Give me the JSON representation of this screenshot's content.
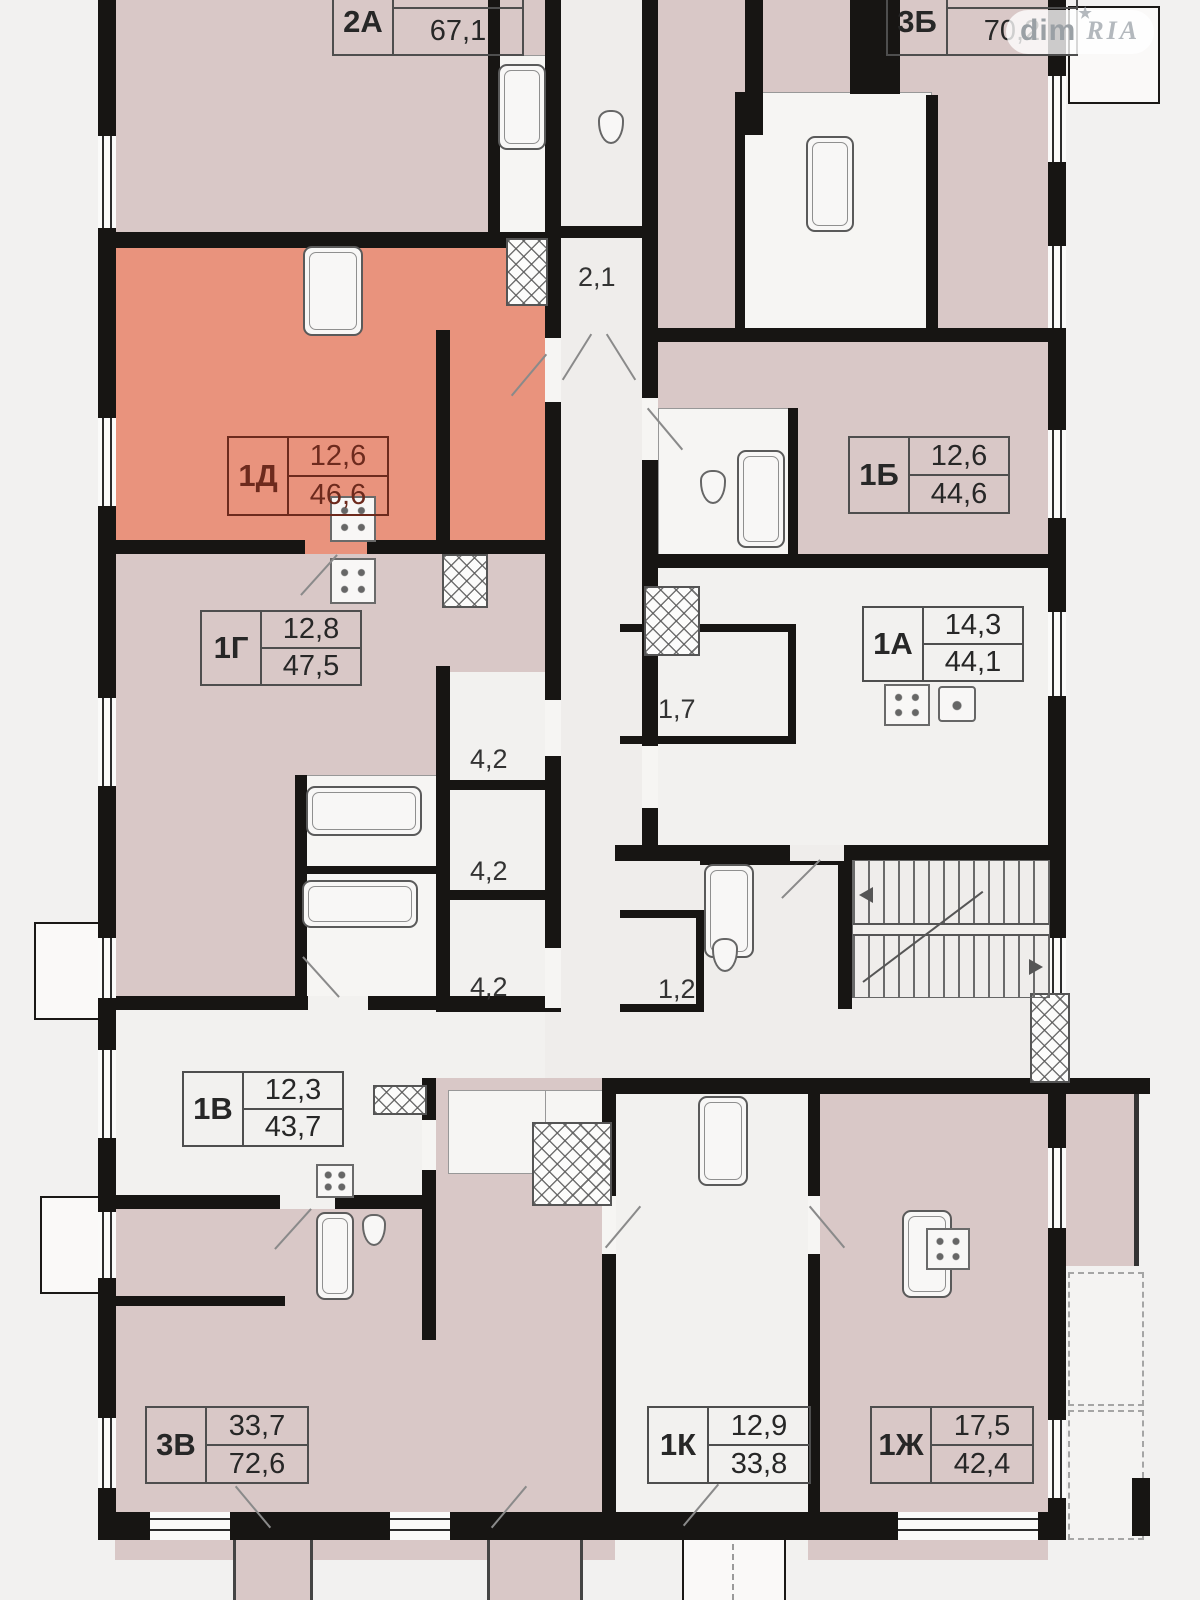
{
  "watermark": {
    "prefix": "dim",
    "brand": "RIA",
    "star": "★"
  },
  "colors": {
    "highlight_fill": "#e9937d",
    "highlight_line": "#6d2a1d",
    "apartment_pink": "#d9c8c7",
    "apartment_white": "#f2f1ef",
    "wall": "#171513",
    "background": "#f2f1f0"
  },
  "apartments": [
    {
      "unit": "2А",
      "living_area": "25,5",
      "total_area": "67,1",
      "highlighted": false
    },
    {
      "unit": "3Б",
      "living_area": "33,7",
      "total_area": "70,2",
      "highlighted": false
    },
    {
      "unit": "1Д",
      "living_area": "12,6",
      "total_area": "46,6",
      "highlighted": true
    },
    {
      "unit": "1Б",
      "living_area": "12,6",
      "total_area": "44,6",
      "highlighted": false
    },
    {
      "unit": "1Г",
      "living_area": "12,8",
      "total_area": "47,5",
      "highlighted": false
    },
    {
      "unit": "1А",
      "living_area": "14,3",
      "total_area": "44,1",
      "highlighted": false
    },
    {
      "unit": "1В",
      "living_area": "12,3",
      "total_area": "43,7",
      "highlighted": false
    },
    {
      "unit": "3В",
      "living_area": "33,7",
      "total_area": "72,6",
      "highlighted": false
    },
    {
      "unit": "1К",
      "living_area": "12,9",
      "total_area": "33,8",
      "highlighted": false
    },
    {
      "unit": "1Ж",
      "living_area": "17,5",
      "total_area": "42,4",
      "highlighted": false
    }
  ],
  "common_rooms": [
    {
      "area": "2,1"
    },
    {
      "area": "4,2"
    },
    {
      "area": "4,2"
    },
    {
      "area": "4,2"
    },
    {
      "area": "1,7"
    },
    {
      "area": "1,2"
    }
  ]
}
